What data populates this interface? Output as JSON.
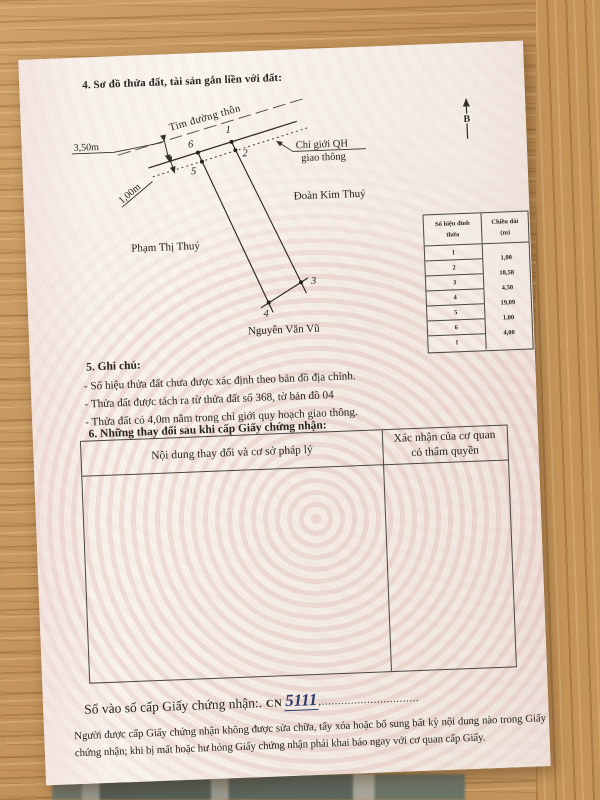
{
  "document": {
    "section4_title": "4. Sơ đồ thửa đất, tài sản gắn liền với đất:",
    "section5": {
      "title": "5. Ghi chú:",
      "notes": [
        "- Số hiệu thửa đất chưa được xác định theo bản đồ địa chính.",
        "- Thửa đất được tách ra từ thửa đất số 368, tờ bản đồ 04",
        "- Thửa đất có 4,0m nằm trong chỉ giới quy hoạch giao thông."
      ]
    },
    "section6": {
      "title": "6. Những thay đổi sau khi cấp Giấy chứng nhận:",
      "table": {
        "col1_header": "Nội dung thay đổi và cơ sở pháp lý",
        "col2_header_line1": "Xác nhận của cơ quan",
        "col2_header_line2": "có thẩm quyền"
      }
    },
    "registry": {
      "label": "Sổ vào sổ cấp Giấy chứng nhận:.",
      "prefix": "CN",
      "number": "5111",
      "dots": ",.............................."
    },
    "notice": "Người được cấp Giấy chứng nhận không được sửa chữa, tẩy xóa hoặc bổ sung bất kỳ nội dung nào trong Giấy chứng nhận; khi bị mất hoặc hư hỏng Giấy chứng nhận phải khai báo ngay với cơ quan cấp Giấy."
  },
  "diagram": {
    "north_label": "B",
    "road_center_label": "Tim đường thôn",
    "road_width_dim": "3,50m",
    "boundary_dim": "1,00m",
    "qh_label_line1": "Chỉ giới QH",
    "qh_label_line2": "giao thông",
    "neighbor_right": "Đoàn Kim Thuý",
    "neighbor_left": "Phạm Thị Thuý",
    "neighbor_bottom": "Nguyễn Văn Vũ",
    "vertices": [
      "1",
      "2",
      "3",
      "4",
      "5",
      "6"
    ]
  },
  "vertex_table": {
    "col1_header_line1": "Số hiệu đỉnh",
    "col1_header_line2": "thửa",
    "col2_header_line1": "Chiều dài",
    "col2_header_line2": "(m)",
    "rows": [
      "1",
      "2",
      "3",
      "4",
      "5",
      "6",
      "1"
    ],
    "lengths": [
      "1,00",
      "18,58",
      "4,50",
      "19,09",
      "1,00",
      "4,00"
    ]
  },
  "colors": {
    "ink": "#27241f",
    "handwriting_ink": "#2c3a68",
    "guilloche_pink": "#c17367",
    "wood": "#c2955d"
  }
}
